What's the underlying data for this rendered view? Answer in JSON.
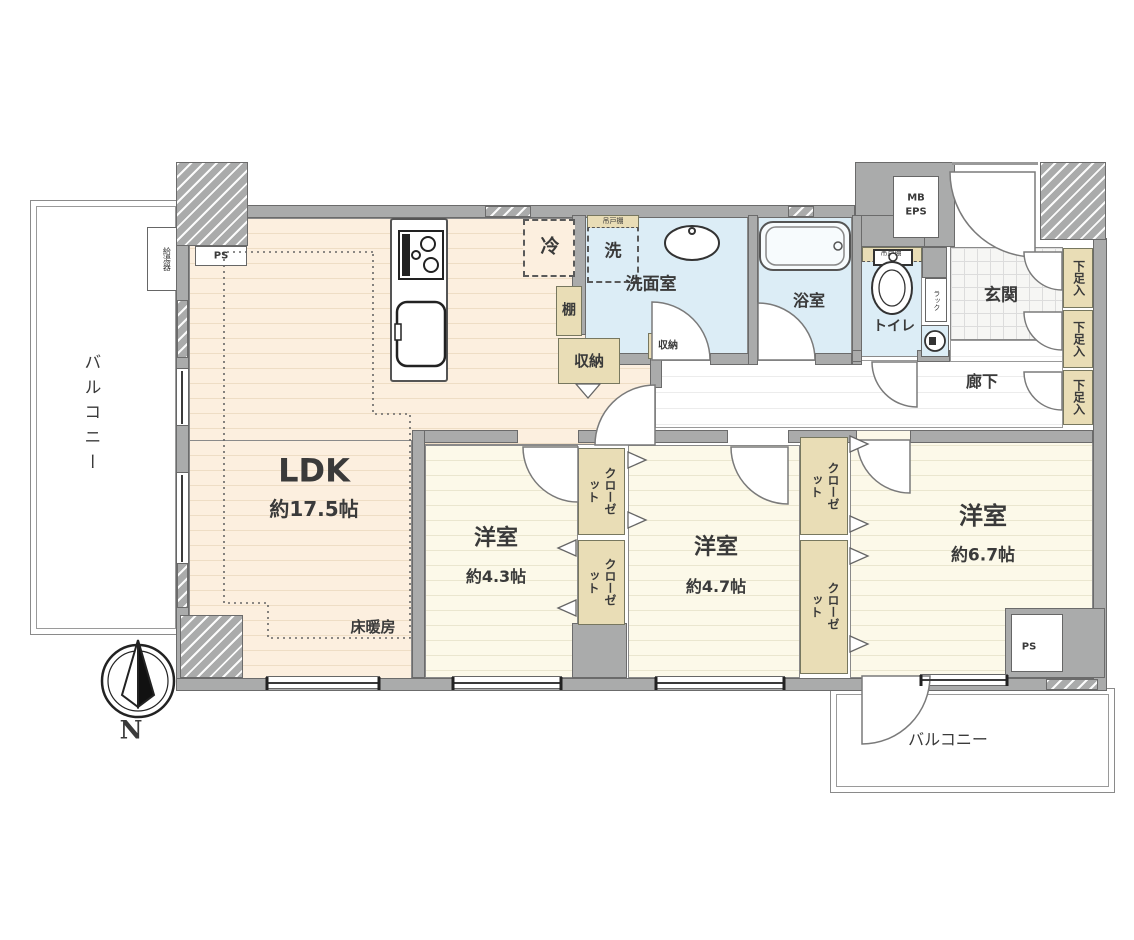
{
  "compass": {
    "north_label": "N"
  },
  "balconies": {
    "left": "バルコニー",
    "bottom": "バルコニー"
  },
  "rooms": {
    "ldk": {
      "name": "LDK",
      "area": "約17.5帖",
      "floor_heating": "床暖房"
    },
    "bedroom_4_3": {
      "name": "洋室",
      "area": "約4.3帖"
    },
    "bedroom_4_7": {
      "name": "洋室",
      "area": "約4.7帖"
    },
    "bedroom_6_7": {
      "name": "洋室",
      "area": "約6.7帖"
    },
    "washroom": {
      "name": "洗面室"
    },
    "bathroom": {
      "name": "浴室"
    },
    "toilet": {
      "name": "トイレ"
    },
    "entrance": {
      "name": "玄関"
    },
    "hallway": {
      "name": "廊下"
    }
  },
  "storage": {
    "closet": "クローゼット",
    "shoe_cabinet": "下足入",
    "storage": "収納",
    "shelf": "棚",
    "hanging_cupboard": "吊戸棚",
    "rack": "ラック"
  },
  "fixtures": {
    "refrigerator": "冷",
    "washing_machine": "洗",
    "water_heater": "給湯器"
  },
  "shafts": {
    "mb": "MB",
    "eps": "EPS",
    "ps": "PS"
  },
  "colors": {
    "wall": "#aaabab",
    "ldk_floor": "#fcefdf",
    "bedroom_floor": "#fcf9e9",
    "wet_area": "#dcedf6",
    "storage_tan": "#e9ddb6",
    "line": "#6b6b6b"
  }
}
